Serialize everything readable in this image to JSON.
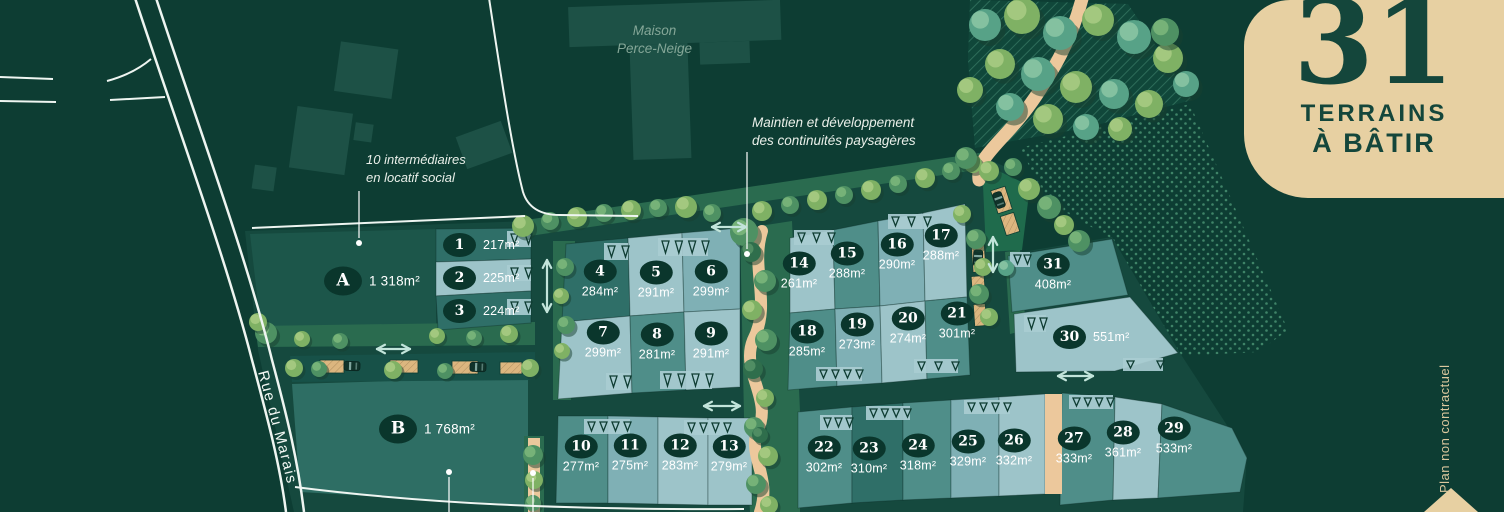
{
  "badge": {
    "number": "31",
    "line1": "TERRAINS",
    "line2": "À BÂTIR"
  },
  "annotations": {
    "maison": [
      "Maison",
      "Perce-Neige"
    ],
    "social": [
      "10 intermédiaires",
      "en locatif social"
    ],
    "paysage": [
      "Maintien et développement",
      "des continuités paysagères"
    ],
    "street": "Rue du Marais",
    "disclaimer": "Plan non contractuel"
  },
  "macro_lots": [
    {
      "id": "A",
      "area": "1 318m²"
    },
    {
      "id": "B",
      "area": "1 768m²"
    }
  ],
  "lots": [
    {
      "num": "1",
      "area": "217m²"
    },
    {
      "num": "2",
      "area": "225m²"
    },
    {
      "num": "3",
      "area": "224m²"
    },
    {
      "num": "4",
      "area": "284m²"
    },
    {
      "num": "5",
      "area": "291m²"
    },
    {
      "num": "6",
      "area": "299m²"
    },
    {
      "num": "7",
      "area": "299m²"
    },
    {
      "num": "8",
      "area": "281m²"
    },
    {
      "num": "9",
      "area": "291m²"
    },
    {
      "num": "10",
      "area": "277m²"
    },
    {
      "num": "11",
      "area": "275m²"
    },
    {
      "num": "12",
      "area": "283m²"
    },
    {
      "num": "13",
      "area": "279m²"
    },
    {
      "num": "14",
      "area": "261m²"
    },
    {
      "num": "15",
      "area": "288m²"
    },
    {
      "num": "16",
      "area": "290m²"
    },
    {
      "num": "17",
      "area": "288m²"
    },
    {
      "num": "18",
      "area": "285m²"
    },
    {
      "num": "19",
      "area": "273m²"
    },
    {
      "num": "20",
      "area": "274m²"
    },
    {
      "num": "21",
      "area": "301m²"
    },
    {
      "num": "22",
      "area": "302m²"
    },
    {
      "num": "23",
      "area": "310m²"
    },
    {
      "num": "24",
      "area": "318m²"
    },
    {
      "num": "25",
      "area": "329m²"
    },
    {
      "num": "26",
      "area": "332m²"
    },
    {
      "num": "27",
      "area": "333m²"
    },
    {
      "num": "28",
      "area": "361m²"
    },
    {
      "num": "29",
      "area": "533m²"
    },
    {
      "num": "30",
      "area": "551m²"
    },
    {
      "num": "31",
      "area": "408m²"
    }
  ],
  "colors": {
    "background": "#0d3d33",
    "badge_background": "#e7d0a2",
    "badge_text": "#14463b",
    "lot_dark": "#2f6f68",
    "lot_medium": "#4f8e89",
    "lot_light": "#9dc4c9",
    "path_sand": "#ecc89c",
    "arrow": "#c2e4da"
  }
}
